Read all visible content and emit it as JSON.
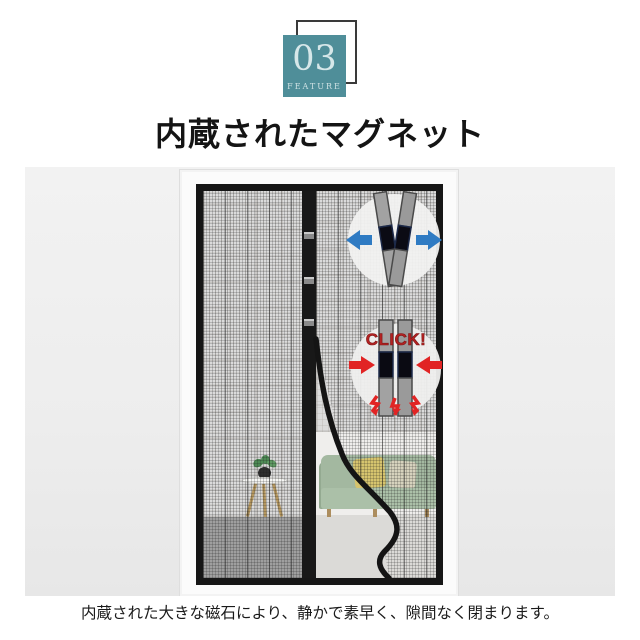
{
  "badge": {
    "number": "03",
    "label": "FEATURE"
  },
  "title": "内蔵されたマグネット",
  "caption": "内蔵された大きな磁石により、静かで素早く、隙間なく閉まります。",
  "callout_open": {
    "name": "magnets-separating",
    "arrow_color": "#2f7bc3"
  },
  "callout_close": {
    "label": "CLICK!",
    "text_color": "#b42222",
    "arrow_color": "#e12424"
  },
  "colors": {
    "badge_teal": "#4f8e99",
    "badge_text": "#d6e7e9",
    "mesh_black": "#161616",
    "sofa_green": "#a3b8a0",
    "cushion_yellow": "#d6c46e",
    "cushion_beige": "#d6d2bd",
    "photo_background": "#efefef"
  }
}
